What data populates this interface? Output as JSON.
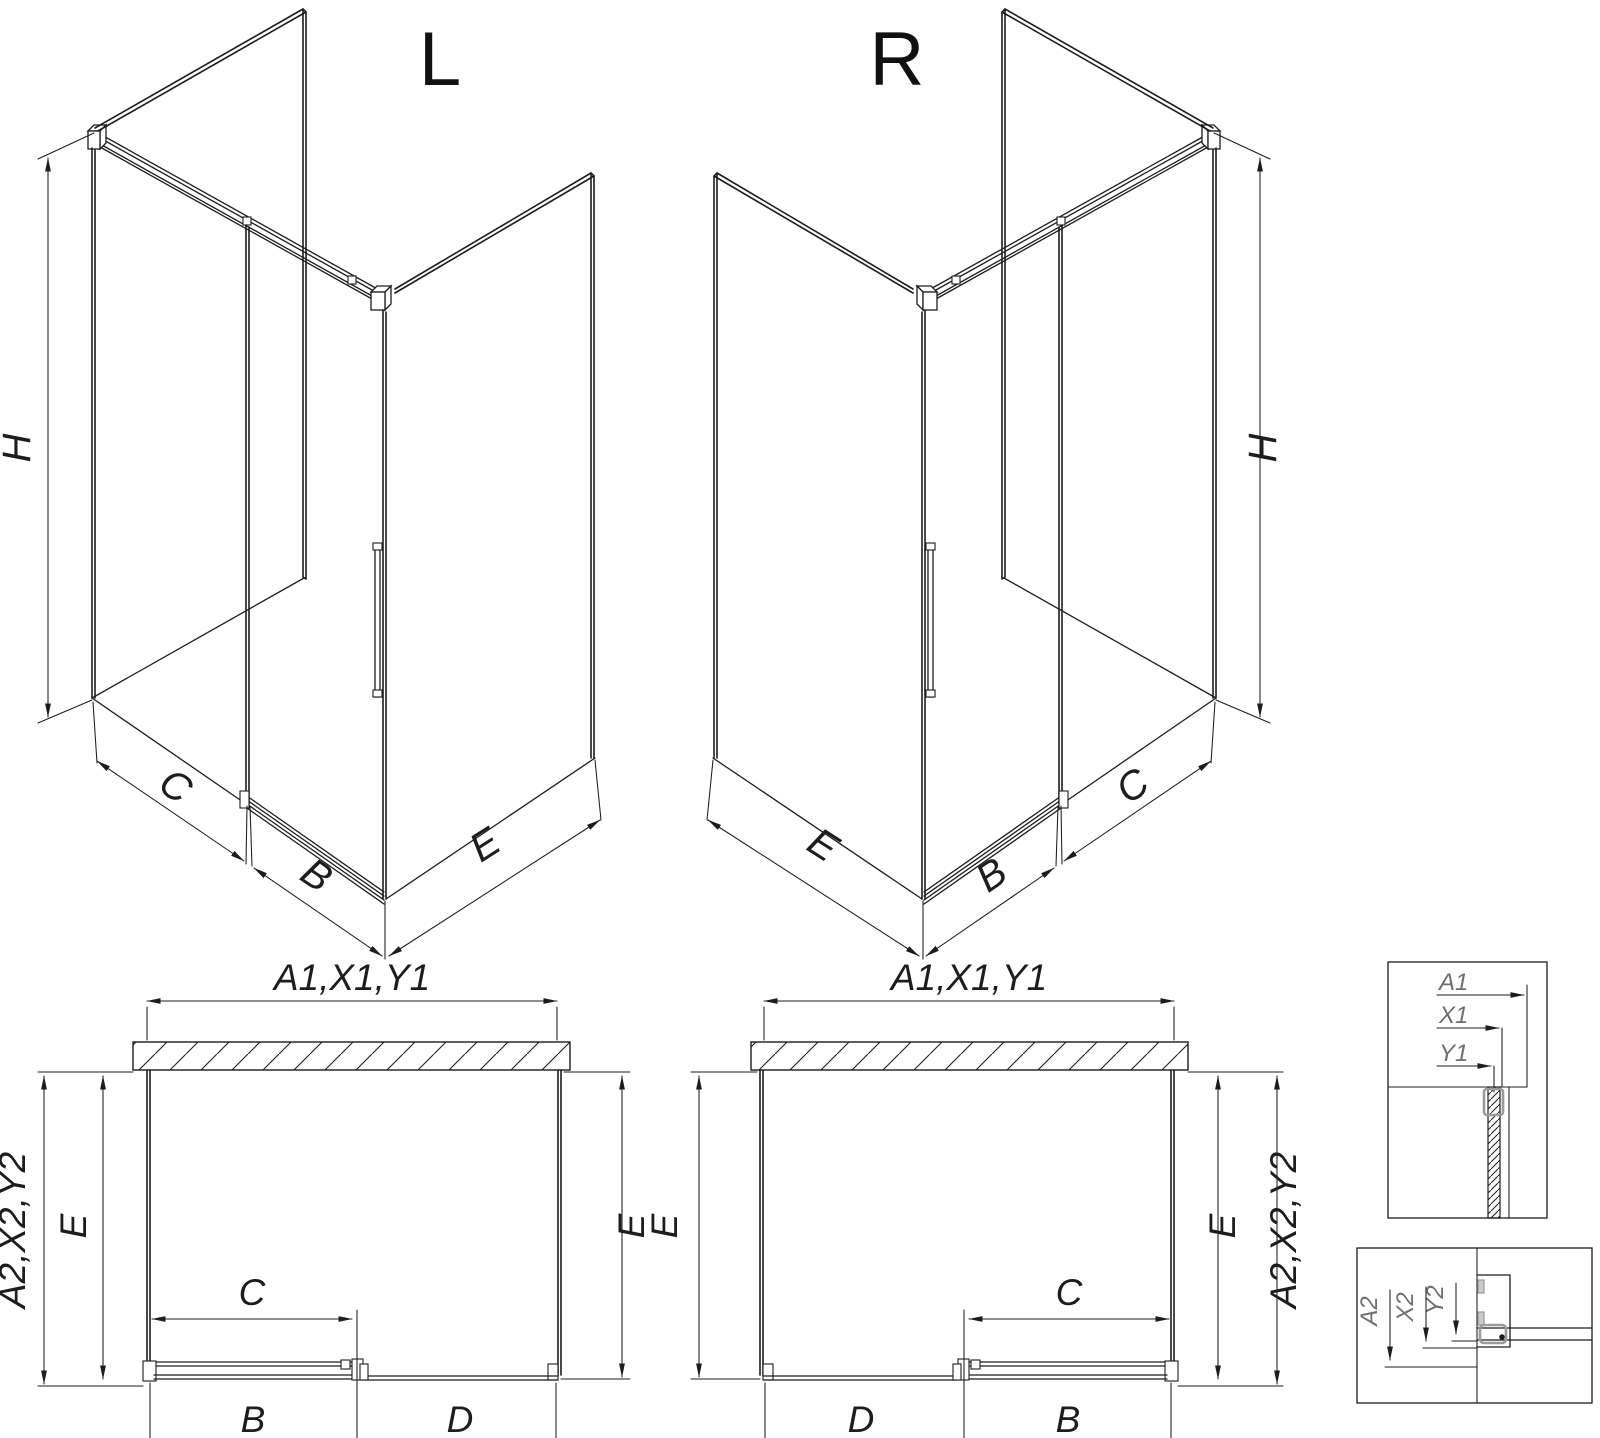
{
  "drawing": {
    "iso_l": {
      "title": "L",
      "dim_height": "H",
      "dim_fixed": "C",
      "dim_door": "B",
      "dim_side": "E"
    },
    "iso_r": {
      "title": "R",
      "dim_height": "H",
      "dim_fixed": "C",
      "dim_door": "B",
      "dim_side": "E"
    },
    "plan_l": {
      "dim_width": "A1,X1,Y1",
      "dim_depth": "A2,X2,Y2",
      "dim_side_left": "E",
      "dim_side_right": "E",
      "dim_opening": "C",
      "dim_door": "B",
      "dim_fixed": "D"
    },
    "plan_r": {
      "dim_width": "A1,X1,Y1",
      "dim_depth": "A2,X2,Y2",
      "dim_side_left": "E",
      "dim_side_right": "E",
      "dim_opening": "C",
      "dim_door": "B",
      "dim_fixed": "D"
    },
    "detail_wall": {
      "labels": [
        "A1",
        "X1",
        "Y1"
      ]
    },
    "detail_floor": {
      "labels": [
        "A2",
        "X2",
        "Y2"
      ]
    },
    "colors": {
      "line": "#1d1d1d",
      "profile_gray": "#9a9a9a",
      "detail_text": "#707070"
    }
  }
}
